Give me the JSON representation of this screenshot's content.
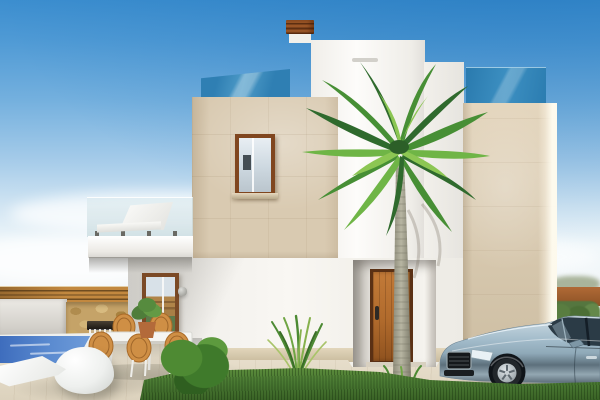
{
  "scene": {
    "title": "Modern two-storey villa exterior — 3D architectural visualization",
    "setting": "daytime, clear blue sky fading to white haze at the horizon",
    "objects": [
      "sky with soft clouds",
      "white rendered tower volume",
      "white chimney with terracotta louvered cap",
      "travertine stone cube volume with picture window",
      "roof-terrace blue glass balustrade (upper left)",
      "roof-terrace blue glass balustrade (upper right)",
      "travertine stone tower (right)",
      "cantilevered balcony with frameless glass railing and white sun lounger",
      "ground-floor tall wood-framed window",
      "two wall sconce lamps",
      "recessed entrance with orange-brown wooden front door",
      "horizontal-slat wooden fence",
      "natural stone water-feature wall with waterfall spout",
      "blue swimming pool with white rim",
      "white designer chaise longue",
      "white curved pod sofa",
      "outdoor dining table with rattan chairs",
      "potted plant by the window",
      "round clipped shrub",
      "ornamental grass shrub",
      "front lawn strip",
      "travertine terrace and driveway paving",
      "silver-blue sedan car parked by the entrance",
      "tall palm tree in front of the facade",
      "distant terracotta boundary wall and hedge (right horizon)"
    ],
    "car": {
      "type": "sedan",
      "facing": "left",
      "visible_part": "front three-quarter, cropped at right edge"
    },
    "door": {
      "material": "wood",
      "style": "vertical planks, dark frame"
    },
    "dining_chairs_visible": 5
  },
  "colors": {
    "sky_top": "#3c8ecf",
    "sky_horizon": "#f0f7fa",
    "glass_blue": "#2f7fb3",
    "stone": "#d9cab1",
    "chimney_cap": "#9a5526",
    "door_wood": "#b06a2c",
    "door_frame": "#5a3014",
    "fence_wood": "#c2883f",
    "rubble": "#c5a368",
    "pool_deep": "#3e6dbd",
    "pool_light": "#6f9cd9",
    "pavement": "#efe7d5",
    "pavement_dark": "#c9bb9e",
    "lawn": "#4a7a33",
    "bush": "#3f7a2b",
    "hedge": "#55763f",
    "horizon_wall": "#b06a36",
    "palm_dark": "#2f6a2d",
    "palm_mid": "#478f35",
    "palm_light": "#6fb546",
    "palm_bright": "#8cc653",
    "trunk_light": "#b7b5a2",
    "trunk_dark": "#8f8d7b",
    "car_top": "#cfdde4",
    "car_body": "#a3bccb",
    "car_lower": "#5d707c",
    "car_window": "#2b3b46",
    "wicker": "#cf8f45",
    "wicker_dark": "#a96a28",
    "terracotta": "#b36a3a"
  }
}
